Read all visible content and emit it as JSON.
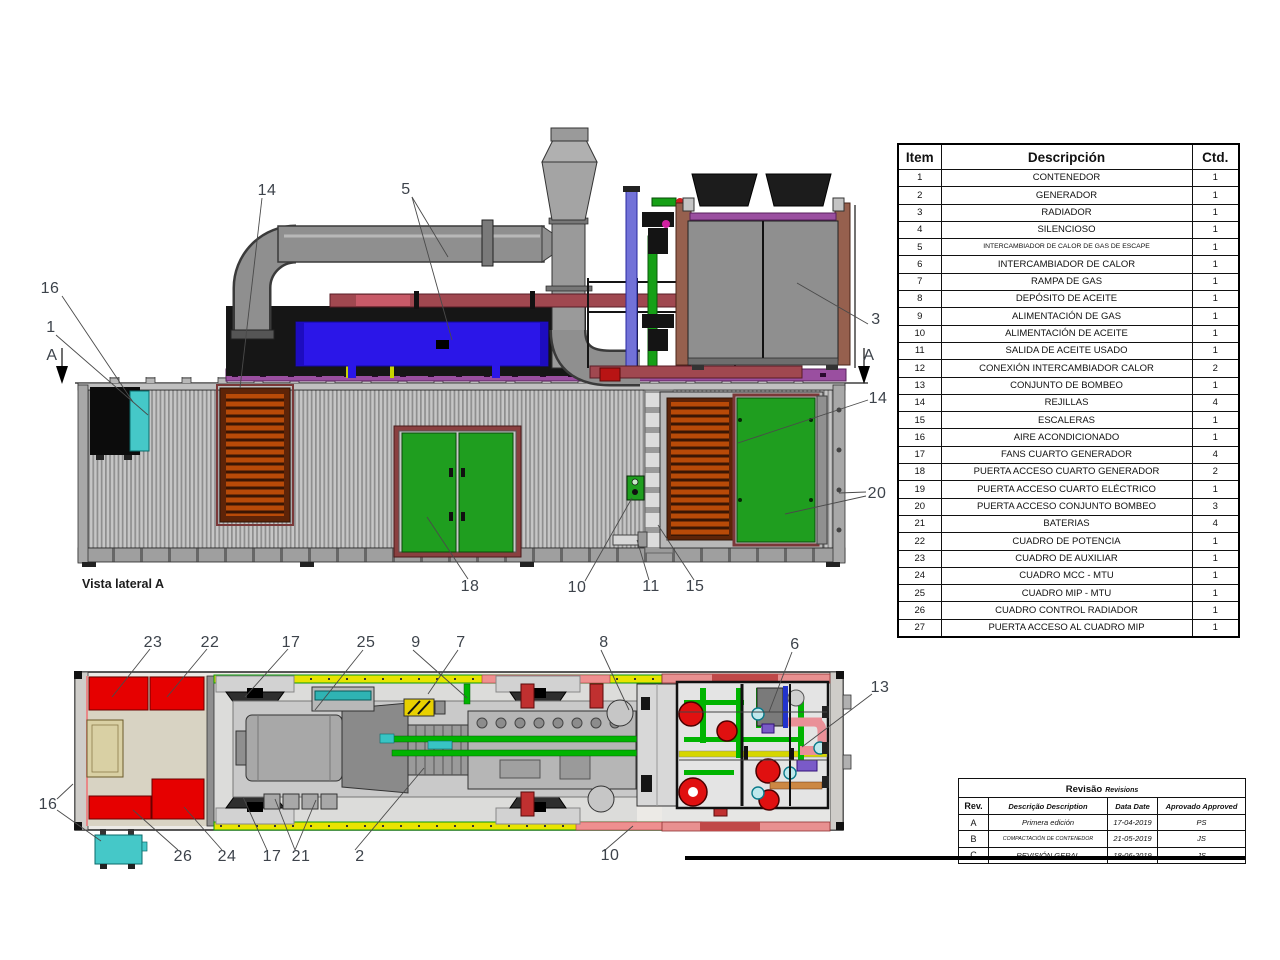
{
  "side_view": {
    "caption": "Vista lateral A",
    "callouts": [
      {
        "label": "16",
        "x": 50,
        "y": 289
      },
      {
        "label": "1",
        "x": 51,
        "y": 328
      },
      {
        "label": "A",
        "x": 52,
        "y": 356
      },
      {
        "label": "14",
        "x": 267,
        "y": 191
      },
      {
        "label": "5",
        "x": 406,
        "y": 190
      },
      {
        "label": "3",
        "x": 876,
        "y": 320
      },
      {
        "label": "A",
        "x": 869,
        "y": 356
      },
      {
        "label": "14",
        "x": 878,
        "y": 399
      },
      {
        "label": "20",
        "x": 877,
        "y": 494
      },
      {
        "label": "18",
        "x": 470,
        "y": 587
      },
      {
        "label": "10",
        "x": 577,
        "y": 588
      },
      {
        "label": "11",
        "x": 651,
        "y": 587
      },
      {
        "label": "15",
        "x": 695,
        "y": 587
      }
    ]
  },
  "plan_view": {
    "callouts": [
      {
        "label": "23",
        "x": 153,
        "y": 643
      },
      {
        "label": "22",
        "x": 210,
        "y": 643
      },
      {
        "label": "17",
        "x": 291,
        "y": 643
      },
      {
        "label": "25",
        "x": 366,
        "y": 643
      },
      {
        "label": "9",
        "x": 416,
        "y": 643
      },
      {
        "label": "7",
        "x": 461,
        "y": 643
      },
      {
        "label": "8",
        "x": 604,
        "y": 643
      },
      {
        "label": "6",
        "x": 795,
        "y": 645
      },
      {
        "label": "13",
        "x": 880,
        "y": 688
      },
      {
        "label": "16",
        "x": 48,
        "y": 805
      },
      {
        "label": "26",
        "x": 183,
        "y": 857
      },
      {
        "label": "24",
        "x": 227,
        "y": 857
      },
      {
        "label": "17",
        "x": 272,
        "y": 857
      },
      {
        "label": "21",
        "x": 301,
        "y": 857
      },
      {
        "label": "2",
        "x": 360,
        "y": 857
      },
      {
        "label": "10",
        "x": 610,
        "y": 856
      }
    ]
  },
  "bom_table": {
    "headers": {
      "item": "Item",
      "desc": "Descripción",
      "qty": "Ctd."
    },
    "rows": [
      [
        "1",
        "CONTENEDOR",
        "1"
      ],
      [
        "2",
        "GENERADOR",
        "1"
      ],
      [
        "3",
        "RADIADOR",
        "1"
      ],
      [
        "4",
        "SILENCIOSO",
        "1"
      ],
      [
        "5",
        "INTERCAMBIADOR DE CALOR DE GAS DE ESCAPE",
        "1"
      ],
      [
        "6",
        "INTERCAMBIADOR DE CALOR",
        "1"
      ],
      [
        "7",
        "RAMPA DE GAS",
        "1"
      ],
      [
        "8",
        "DEPÓSITO DE ACEITE",
        "1"
      ],
      [
        "9",
        "ALIMENTACIÓN DE GAS",
        "1"
      ],
      [
        "10",
        "ALIMENTACIÓN DE ACEITE",
        "1"
      ],
      [
        "11",
        "SALIDA DE ACEITE USADO",
        "1"
      ],
      [
        "12",
        "CONEXIÓN INTERCAMBIADOR CALOR",
        "2"
      ],
      [
        "13",
        "CONJUNTO DE BOMBEO",
        "1"
      ],
      [
        "14",
        "REJILLAS",
        "4"
      ],
      [
        "15",
        "ESCALERAS",
        "1"
      ],
      [
        "16",
        "AIRE ACONDICIONADO",
        "1"
      ],
      [
        "17",
        "FANS CUARTO GENERADOR",
        "4"
      ],
      [
        "18",
        "PUERTA ACCESO CUARTO GENERADOR",
        "2"
      ],
      [
        "19",
        "PUERTA ACCESO CUARTO ELÉCTRICO",
        "1"
      ],
      [
        "20",
        "PUERTA ACCESO CONJUNTO BOMBEO",
        "3"
      ],
      [
        "21",
        "BATERIAS",
        "4"
      ],
      [
        "22",
        "CUADRO DE POTENCIA",
        "1"
      ],
      [
        "23",
        "CUADRO DE AUXILIAR",
        "1"
      ],
      [
        "24",
        "CUADRO MCC - MTU",
        "1"
      ],
      [
        "25",
        "CUADRO MIP - MTU",
        "1"
      ],
      [
        "26",
        "CUADRO CONTROL RADIADOR",
        "1"
      ],
      [
        "27",
        "PUERTA ACCESO AL CUADRO MIP",
        "1"
      ]
    ]
  },
  "revision_table": {
    "title": "Revisão",
    "title_en": "Revisions",
    "headers": {
      "rev": "Rev.",
      "desc": "Descrição Description",
      "date": "Data Date",
      "approved": "Aprovado Approved"
    },
    "rows": [
      [
        "A",
        "Primera edición",
        "17-04-2019",
        "PS"
      ],
      [
        "B",
        "COMPACTACIÓN DE CONTENEDOR",
        "21-05-2019",
        "JS"
      ],
      [
        "C",
        "REVISIÓN GERAL",
        "18-06-2019",
        "JS"
      ]
    ]
  },
  "palette": {
    "door_green": "#1f9e1f",
    "grille_orange": "#b84a08",
    "exchanger_blue": "#2b16e8",
    "cabinet_red": "#e60000",
    "ac_teal": "#45c8c8",
    "pipe_maroon": "#a04850",
    "pipe_green": "#00b400",
    "tray_yellow": "#e8e400"
  }
}
